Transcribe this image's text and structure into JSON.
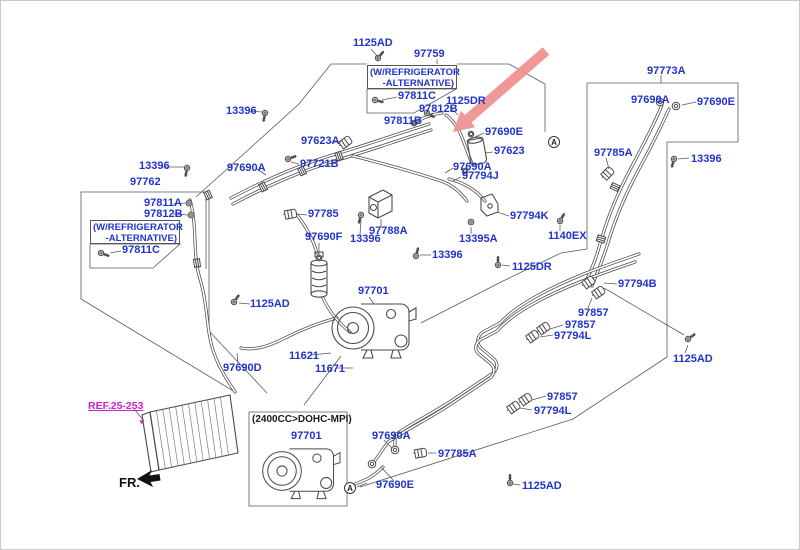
{
  "diagram": {
    "colors": {
      "label": "#2233cc",
      "link": "#cc22cc",
      "arrow": "#ee8f8f",
      "line": "#4a4a4a",
      "ink": "#1a1a1a"
    },
    "ref_note": {
      "text": "REF.25-253"
    },
    "fr_marker": {
      "text": "FR."
    },
    "view_markers": [
      {
        "text": "A",
        "x": 553,
        "y": 141
      },
      {
        "text": "A",
        "x": 349,
        "y": 487
      }
    ],
    "notes": [
      {
        "lines": [
          "(W/REFRIGERATOR",
          "-ALTERNATIVE)"
        ],
        "x": 366,
        "y": 64,
        "w": 90,
        "h": 24
      },
      {
        "lines": [
          "(W/REFRIGERATOR",
          "-ALTERNATIVE)"
        ],
        "x": 89,
        "y": 219,
        "w": 90,
        "h": 24
      }
    ],
    "labels": [
      {
        "text": "1125AD",
        "x": 352,
        "y": 37
      },
      {
        "text": "97759",
        "x": 413,
        "y": 48
      },
      {
        "text": "97811C",
        "x": 397,
        "y": 90
      },
      {
        "text": "1125DR",
        "x": 445,
        "y": 95
      },
      {
        "text": "97812B",
        "x": 418,
        "y": 103
      },
      {
        "text": "97811B",
        "x": 383,
        "y": 115
      },
      {
        "text": "13396",
        "x": 225,
        "y": 105
      },
      {
        "text": "97623A",
        "x": 300,
        "y": 135
      },
      {
        "text": "97690E",
        "x": 484,
        "y": 126
      },
      {
        "text": "97623",
        "x": 493,
        "y": 145
      },
      {
        "text": "97690A",
        "x": 452,
        "y": 161
      },
      {
        "text": "97794J",
        "x": 461,
        "y": 170
      },
      {
        "text": "97690A",
        "x": 226,
        "y": 162
      },
      {
        "text": "97721B",
        "x": 299,
        "y": 158
      },
      {
        "text": "13396",
        "x": 138,
        "y": 160
      },
      {
        "text": "97762",
        "x": 129,
        "y": 176
      },
      {
        "text": "97811A",
        "x": 143,
        "y": 197
      },
      {
        "text": "97812B",
        "x": 143,
        "y": 208
      },
      {
        "text": "97811C",
        "x": 121,
        "y": 244
      },
      {
        "text": "97785",
        "x": 307,
        "y": 208
      },
      {
        "text": "97788A",
        "x": 368,
        "y": 225
      },
      {
        "text": "13396",
        "x": 349,
        "y": 233
      },
      {
        "text": "97690F",
        "x": 304,
        "y": 231
      },
      {
        "text": "97794K",
        "x": 509,
        "y": 210
      },
      {
        "text": "13395A",
        "x": 458,
        "y": 233
      },
      {
        "text": "1140EX",
        "x": 547,
        "y": 230
      },
      {
        "text": "13396",
        "x": 431,
        "y": 249
      },
      {
        "text": "1125DR",
        "x": 511,
        "y": 261
      },
      {
        "text": "97773A",
        "x": 646,
        "y": 65
      },
      {
        "text": "97690A",
        "x": 630,
        "y": 94
      },
      {
        "text": "97690E",
        "x": 696,
        "y": 96
      },
      {
        "text": "97785A",
        "x": 593,
        "y": 147
      },
      {
        "text": "13396",
        "x": 690,
        "y": 153
      },
      {
        "text": "1125AD",
        "x": 249,
        "y": 298
      },
      {
        "text": "97701",
        "x": 357,
        "y": 285
      },
      {
        "text": "11621",
        "x": 288,
        "y": 350
      },
      {
        "text": "11671",
        "x": 314,
        "y": 363
      },
      {
        "text": "97690D",
        "x": 222,
        "y": 362
      },
      {
        "text": "97794B",
        "x": 617,
        "y": 278
      },
      {
        "text": "97857",
        "x": 577,
        "y": 307
      },
      {
        "text": "97857",
        "x": 564,
        "y": 319
      },
      {
        "text": "97794L",
        "x": 553,
        "y": 330
      },
      {
        "text": "1125AD",
        "x": 672,
        "y": 353
      },
      {
        "text": "97857",
        "x": 546,
        "y": 391
      },
      {
        "text": "97794L",
        "x": 533,
        "y": 405
      },
      {
        "text": "(2400CC>DOHC-MPI)",
        "x": 251,
        "y": 413,
        "c": "ink"
      },
      {
        "text": "97701",
        "x": 290,
        "y": 430
      },
      {
        "text": "97690A",
        "x": 371,
        "y": 430
      },
      {
        "text": "97785A",
        "x": 437,
        "y": 448
      },
      {
        "text": "97690E",
        "x": 375,
        "y": 479
      },
      {
        "text": "1125AD",
        "x": 521,
        "y": 480
      }
    ],
    "parts": [
      {
        "t": "bolt",
        "x": 377,
        "y": 57,
        "r": 220
      },
      {
        "t": "bolt",
        "x": 374,
        "y": 99,
        "r": 285
      },
      {
        "t": "bolt",
        "x": 264,
        "y": 112,
        "r": 10
      },
      {
        "t": "bolt",
        "x": 186,
        "y": 167,
        "r": 10
      },
      {
        "t": "bolt",
        "x": 100,
        "y": 252,
        "r": 290
      },
      {
        "t": "bolt",
        "x": 233,
        "y": 301,
        "r": 215
      },
      {
        "t": "bolt",
        "x": 360,
        "y": 214,
        "r": 15
      },
      {
        "t": "bolt",
        "x": 415,
        "y": 255,
        "r": 195
      },
      {
        "t": "bolt",
        "x": 497,
        "y": 264,
        "r": 180
      },
      {
        "t": "bolt",
        "x": 559,
        "y": 220,
        "r": 210
      },
      {
        "t": "bolt",
        "x": 673,
        "y": 158,
        "r": 15
      },
      {
        "t": "bolt",
        "x": 687,
        "y": 338,
        "r": 235
      },
      {
        "t": "bolt",
        "x": 509,
        "y": 482,
        "r": 180
      },
      {
        "t": "bolt",
        "x": 426,
        "y": 112,
        "r": 300
      },
      {
        "t": "bolt",
        "x": 287,
        "y": 158,
        "r": 250
      },
      {
        "t": "nut",
        "x": 188,
        "y": 202
      },
      {
        "t": "nut",
        "x": 190,
        "y": 214
      },
      {
        "t": "nut",
        "x": 470,
        "y": 221
      },
      {
        "t": "oring",
        "x": 318,
        "y": 257
      },
      {
        "t": "oring",
        "x": 413,
        "y": 122
      },
      {
        "t": "oring",
        "x": 470,
        "y": 133
      },
      {
        "t": "oring",
        "x": 464,
        "y": 170
      },
      {
        "t": "clamp",
        "x": 345,
        "y": 141,
        "r": -35
      },
      {
        "t": "clamp",
        "x": 290,
        "y": 213,
        "r": -10
      },
      {
        "t": "clamp",
        "x": 607,
        "y": 172,
        "r": -45
      },
      {
        "t": "clamp",
        "x": 420,
        "y": 452,
        "r": -10
      },
      {
        "t": "clamp",
        "x": 588,
        "y": 281,
        "r": -35
      },
      {
        "t": "clamp",
        "x": 598,
        "y": 291,
        "r": -35
      },
      {
        "t": "clamp",
        "x": 543,
        "y": 327,
        "r": -35
      },
      {
        "t": "clamp",
        "x": 532,
        "y": 335,
        "r": -35
      },
      {
        "t": "clamp",
        "x": 525,
        "y": 398,
        "r": -35
      },
      {
        "t": "clamp",
        "x": 513,
        "y": 406,
        "r": -35
      },
      {
        "t": "flange",
        "x": 394,
        "y": 449
      },
      {
        "t": "flange",
        "x": 371,
        "y": 463
      },
      {
        "t": "flange",
        "x": 659,
        "y": 101
      },
      {
        "t": "flange",
        "x": 675,
        "y": 105
      },
      {
        "t": "coupling",
        "x": 262,
        "y": 186,
        "r": -28
      },
      {
        "t": "coupling",
        "x": 301,
        "y": 170,
        "r": -25
      },
      {
        "t": "coupling",
        "x": 338,
        "y": 155,
        "r": -20
      },
      {
        "t": "coupling",
        "x": 614,
        "y": 186,
        "r": -65
      },
      {
        "t": "coupling",
        "x": 600,
        "y": 238,
        "r": -72
      },
      {
        "t": "coupling",
        "x": 207,
        "y": 194,
        "r": -25
      },
      {
        "t": "coupling",
        "x": 196,
        "y": 262,
        "r": -8
      }
    ]
  }
}
